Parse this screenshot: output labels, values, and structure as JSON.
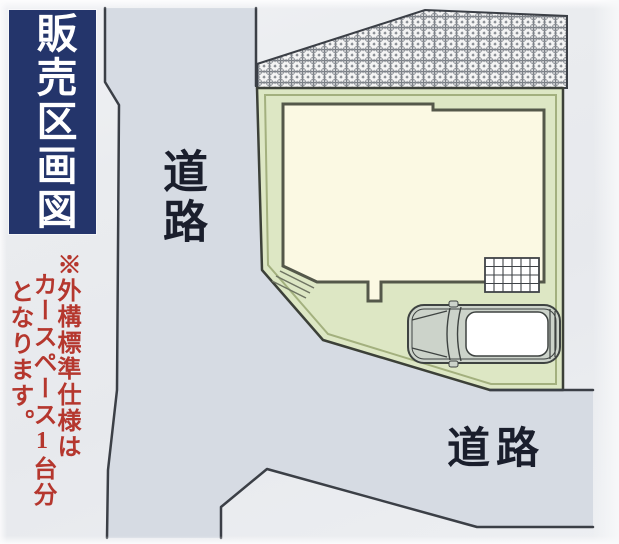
{
  "title_banner": {
    "label": "販売区画図",
    "bg_color": "#24356b",
    "text_color": "#ffffff"
  },
  "note": {
    "lines": [
      "※外構標準仕様は",
      "カースペース1台分",
      "となります。"
    ],
    "full_text": "※外構標準仕様はカースペース1台分となります。",
    "color": "#b5372e"
  },
  "labels": {
    "road_left": "道路",
    "road_bottom": "道路"
  },
  "site_plan": {
    "plot_fill": "#dde7c4",
    "plot_inner_line": "#a3b07e",
    "plot_outline": "#3c4038",
    "building_fill": "#fbf9e3",
    "building_outline": "#54584a",
    "road_fill": "#d6dbe3",
    "road_line": "#3b3f46",
    "hatch_circle_color": "#787d84",
    "hatch_bg": "#f4f4f4",
    "grid_fill": "#ffffff",
    "grid_line": "#3f4347",
    "car_body_fill": "#ccd3ca",
    "car_roof_fill": "#ffffff",
    "car_outline": "#3e4341",
    "elements": [
      "vertical-road",
      "bottom-road",
      "neighbor-parcel-hatch",
      "sale-plot",
      "building-footprint",
      "entrance-steps",
      "porch",
      "grid-terrace",
      "car-space-car"
    ]
  }
}
